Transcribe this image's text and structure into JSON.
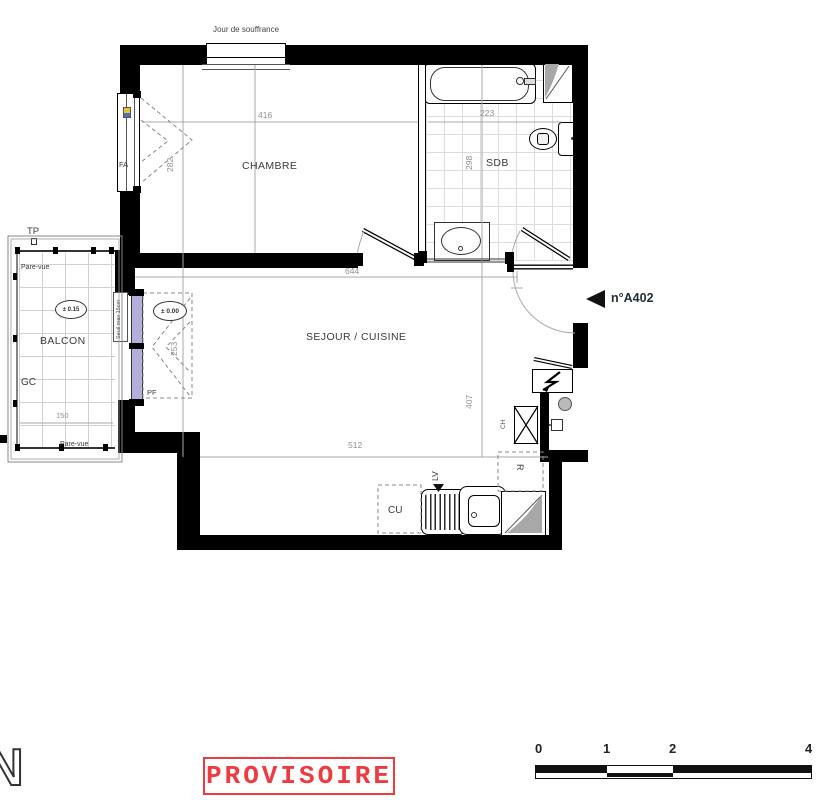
{
  "plan": {
    "apartment_label": "n°A402",
    "stamp": "PROVISOIRE",
    "north_letter": "N",
    "rooms": {
      "chambre": "CHAMBRE",
      "sdb": "SDB",
      "sejour": "SEJOUR / CUISINE",
      "balcon": "BALCON"
    },
    "labels": {
      "jour_de_souffrance": "Jour de souffrance",
      "tp": "TP",
      "gc": "GC",
      "pare_vue_top": "Pare-vue",
      "pare_vue_bottom": "Pare-vue",
      "pf": "PF",
      "fa": "FA",
      "seuil": "Seuil max 15cm",
      "level_balcon": "± 0.15",
      "level_sejour": "± 0.00",
      "cu": "CU",
      "lv": "LV",
      "refrigerator": "R",
      "ch": "CH"
    },
    "dimensions": {
      "chambre_width": "416",
      "chambre_depth": "282",
      "sdb_width": "223",
      "sdb_depth": "298",
      "sejour_width": "644",
      "pf_width": "253",
      "sejour_depth": "407",
      "sejour_width_bottom": "512",
      "balcon_width": "150"
    },
    "scale_bar": {
      "ticks": [
        "0",
        "1",
        "2",
        "4"
      ]
    },
    "colors": {
      "stamp_red": "#ee3b40",
      "glazing": "#b2b0da",
      "shaft_gray": "#a8a8a8"
    }
  }
}
